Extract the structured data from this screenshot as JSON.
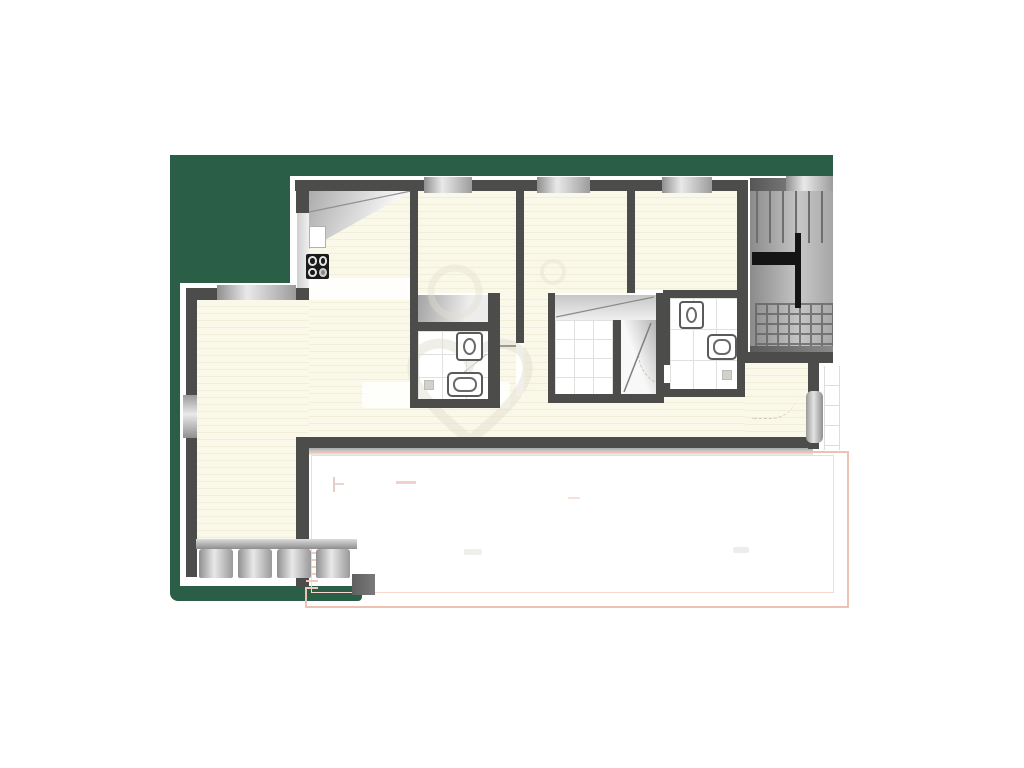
{
  "document": {
    "kind": "architectural-floor-plan",
    "visible_text": "none"
  },
  "colors": {
    "green": "#2B5E46",
    "cream": "#FAF8E8",
    "creamStripe": "#F1EEDA",
    "wall": "#4C4C4B",
    "tileLine": "#E0E0DE",
    "pinkOuter": "#EFC1B3",
    "pinkInner": "#F7D9CF",
    "stairDark": "#565656",
    "stairLight": "#C6C6C6",
    "handrail": "#141414",
    "fixtureLine": "#5A5A5A",
    "shadow": "#A9A9A9",
    "watermark": "#E3E0D1",
    "white": "#FFFFFF"
  },
  "plan": {
    "site_area": {
      "shape": "L-shaped backdrop",
      "color_name": "dark-green"
    },
    "rooms": [
      {
        "name": "kitchen-dining",
        "features": [
          "counter",
          "sink",
          "stove-4-burners"
        ]
      },
      {
        "name": "living-room",
        "features": [
          "balcony-railing",
          "left-window"
        ]
      },
      {
        "name": "bedroom-1",
        "features": []
      },
      {
        "name": "bedroom-2",
        "features": []
      },
      {
        "name": "bedroom-3",
        "features": []
      },
      {
        "name": "bathroom-1",
        "features": [
          "shower",
          "toilet",
          "sink",
          "floor-drain"
        ]
      },
      {
        "name": "shower-room",
        "features": [
          "shower-tiles",
          "door-swing"
        ]
      },
      {
        "name": "bathroom-2",
        "features": [
          "toilet",
          "sink",
          "floor-drain",
          "door-arc"
        ]
      },
      {
        "name": "entry-hall",
        "features": [
          "entry-door"
        ]
      },
      {
        "name": "staircase",
        "features": [
          "treads",
          "t-handrail",
          "hatched-lower-flight"
        ]
      },
      {
        "name": "terrace",
        "features": [
          "double-pink-outline",
          "faint-marks"
        ]
      }
    ],
    "windows": {
      "top_wall": 3,
      "living_room_top_wall": 1,
      "left_wall": 1
    },
    "stair": {
      "tread_lines": 6,
      "handrail_shape": "T"
    },
    "watermark": {
      "present": true,
      "shape": "heart-outline-with-rings"
    }
  }
}
